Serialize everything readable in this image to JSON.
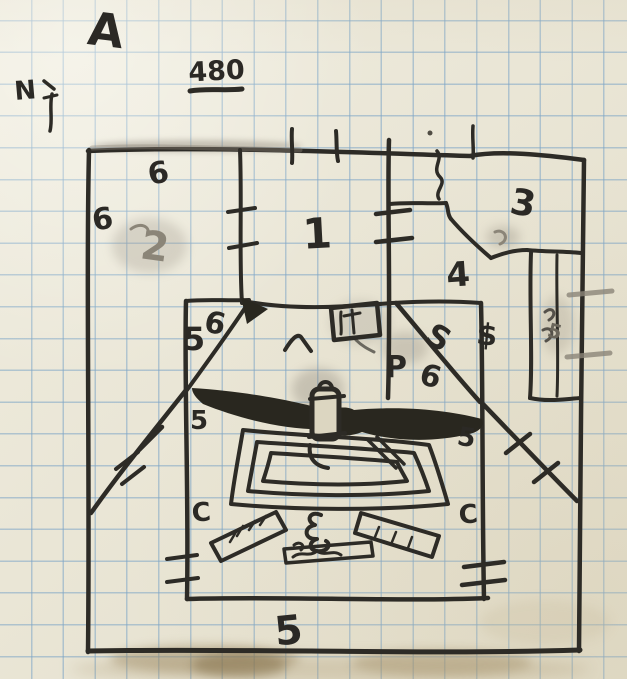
{
  "annotations": {
    "corner_letter": "A",
    "compass_letter": "N",
    "scale_text": "480"
  },
  "room_labels": {
    "one": "1",
    "two": "2",
    "three": "3",
    "four": "4",
    "five_triangle": "5",
    "five_west": "5",
    "five_east": "5",
    "five_south": "5",
    "six_outer_north": "6",
    "six_outer_west": "6",
    "six_triangle": "6",
    "six_mid": "6"
  },
  "marks": {
    "p_mark": "P",
    "s_mark": "S",
    "treasure_mark": "$",
    "c_left": "C",
    "c_right": "C",
    "closet_mark": "5"
  },
  "colors": {
    "paper": "#e9e5d5",
    "grid": "#7da5c6",
    "ink": "#2d2b26",
    "pencil": "#8b8578",
    "stain": "#9c8a61"
  }
}
